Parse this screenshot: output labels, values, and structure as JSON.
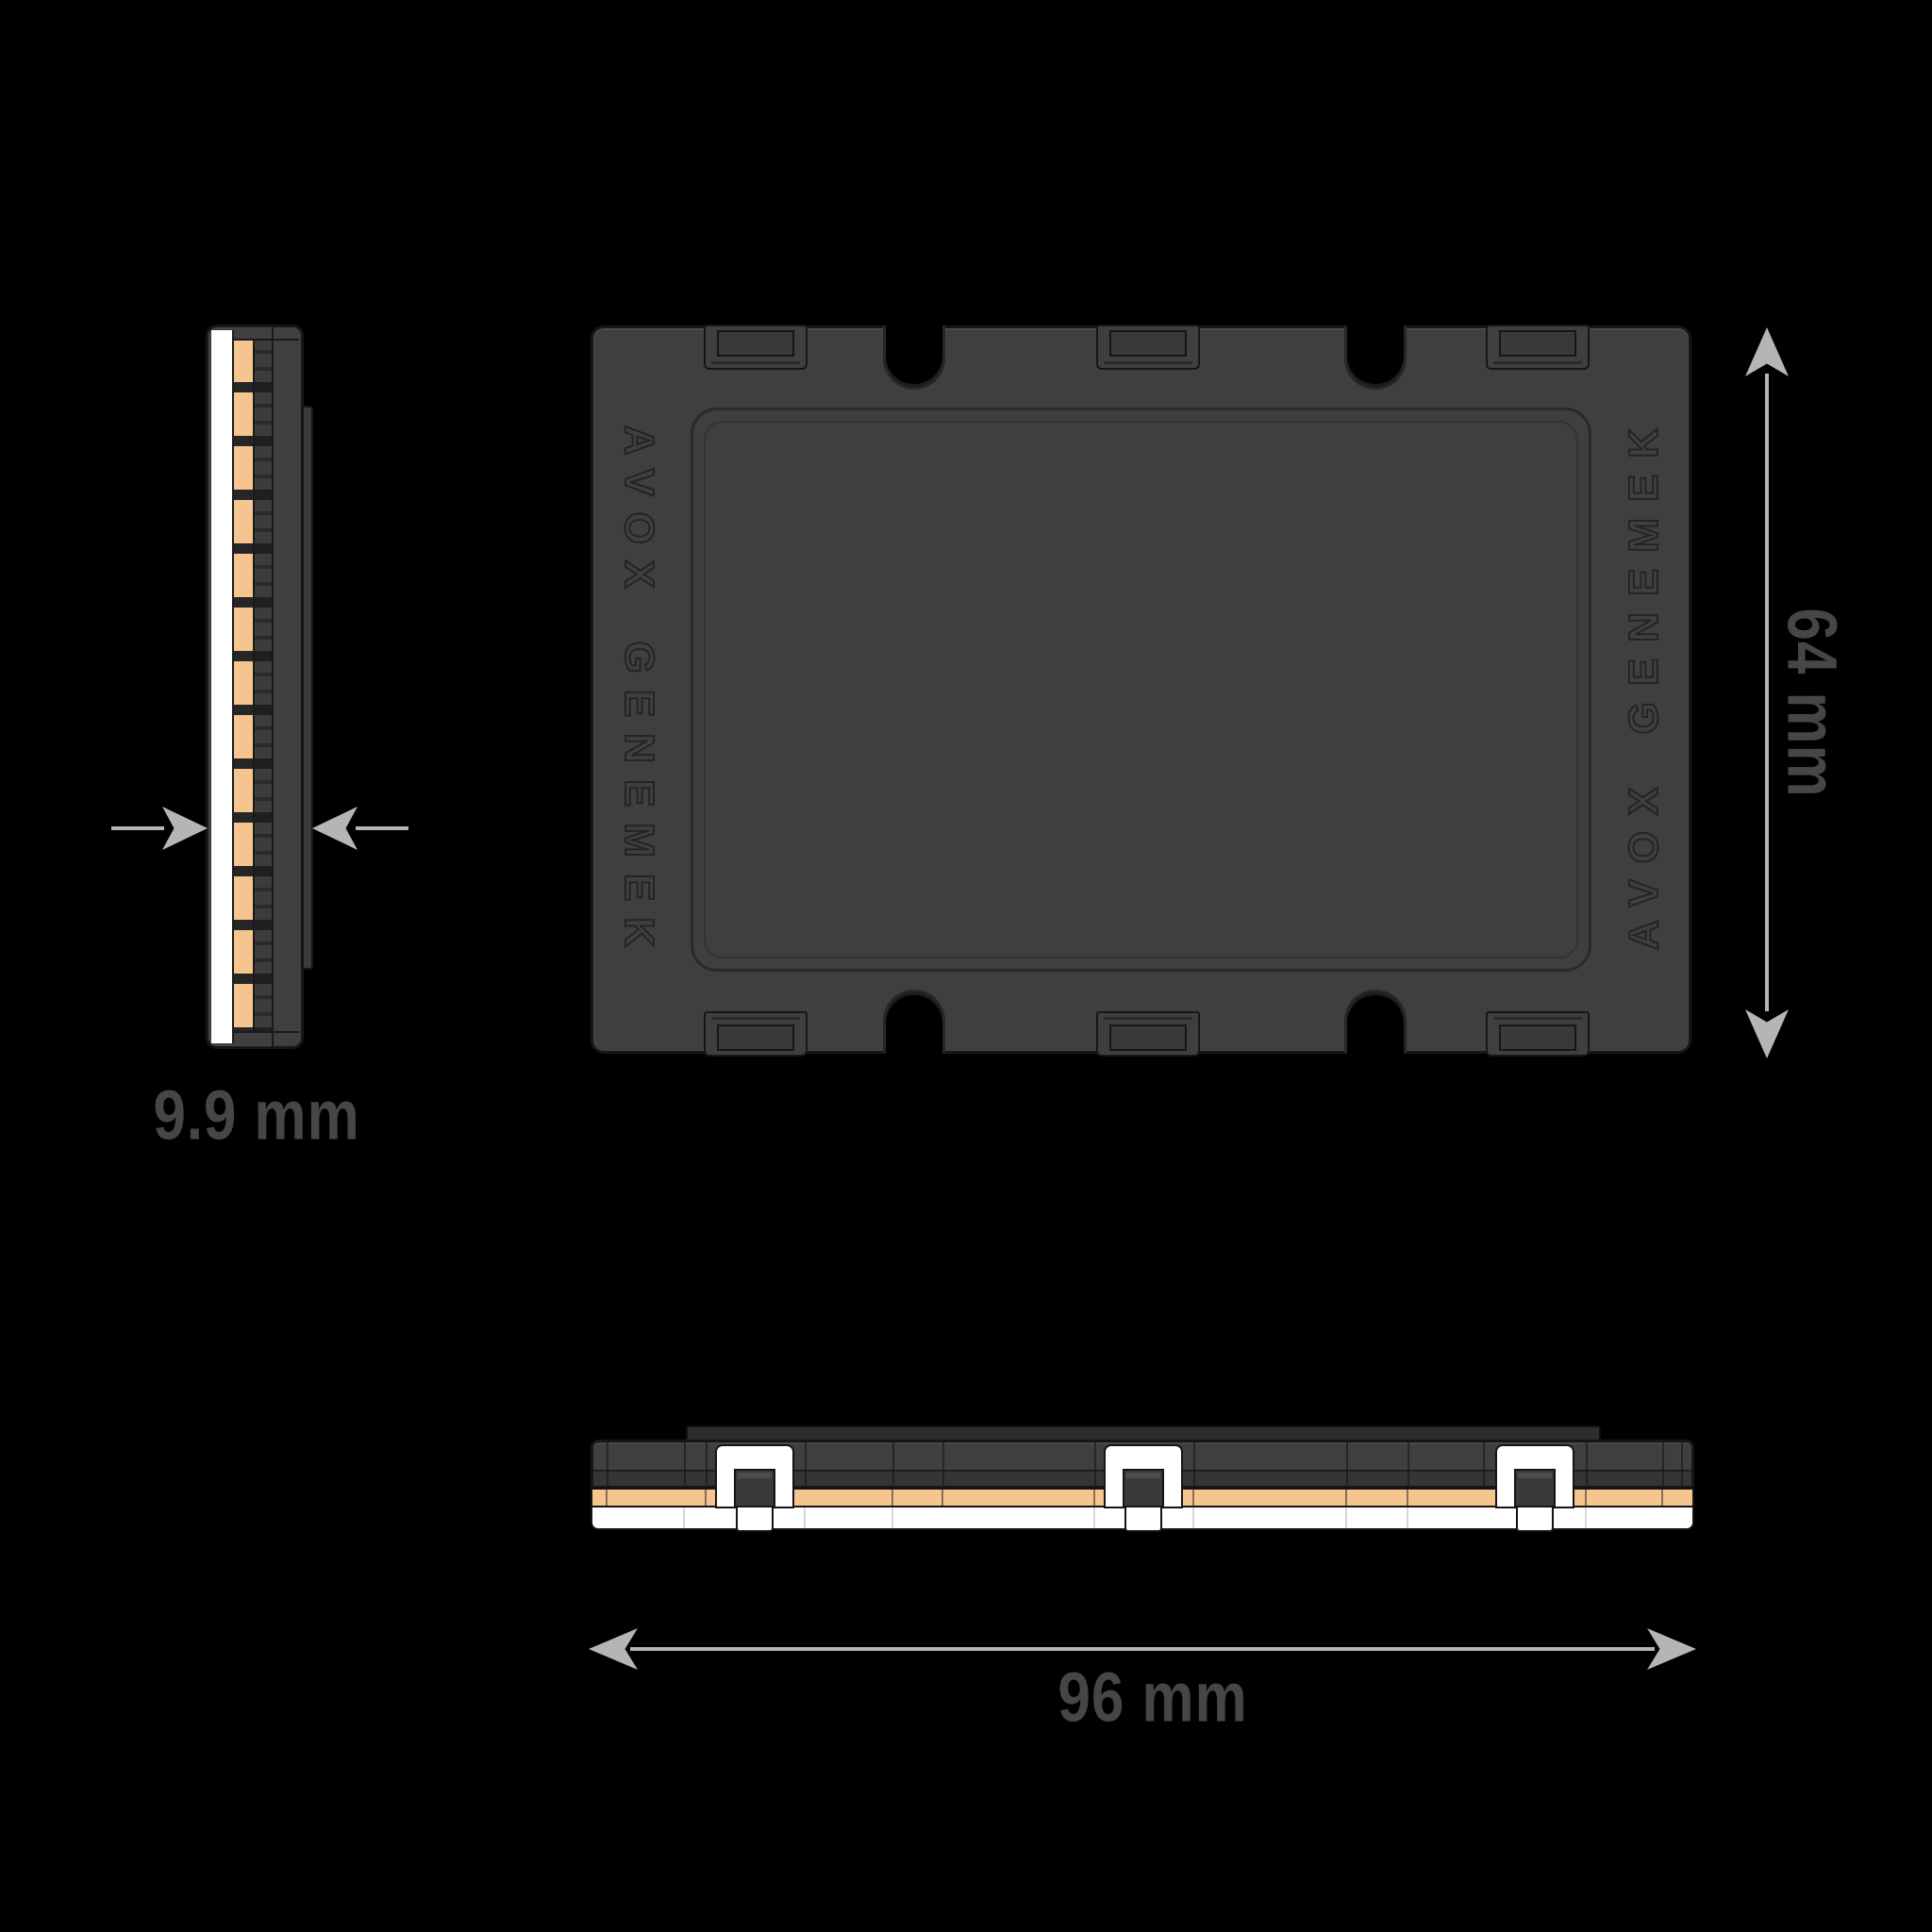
{
  "engraving": {
    "left": "AVOX GENEMEK",
    "right": "AVOX GENEMEK"
  },
  "dimensions": {
    "thickness": "9.9 mm",
    "height": "64 mm",
    "width": "96 mm"
  },
  "colors": {
    "background": "#000000",
    "case_body": "#3f3f3f",
    "case_outline": "#161616",
    "panel_line": "#2a2a2a",
    "engraving_stroke": "#242424",
    "pcb_orange": "#f6c48e",
    "connector_white": "#ffffff",
    "arrow_gray": "#b5b5b5",
    "dimension_label_gray": "#464646"
  }
}
